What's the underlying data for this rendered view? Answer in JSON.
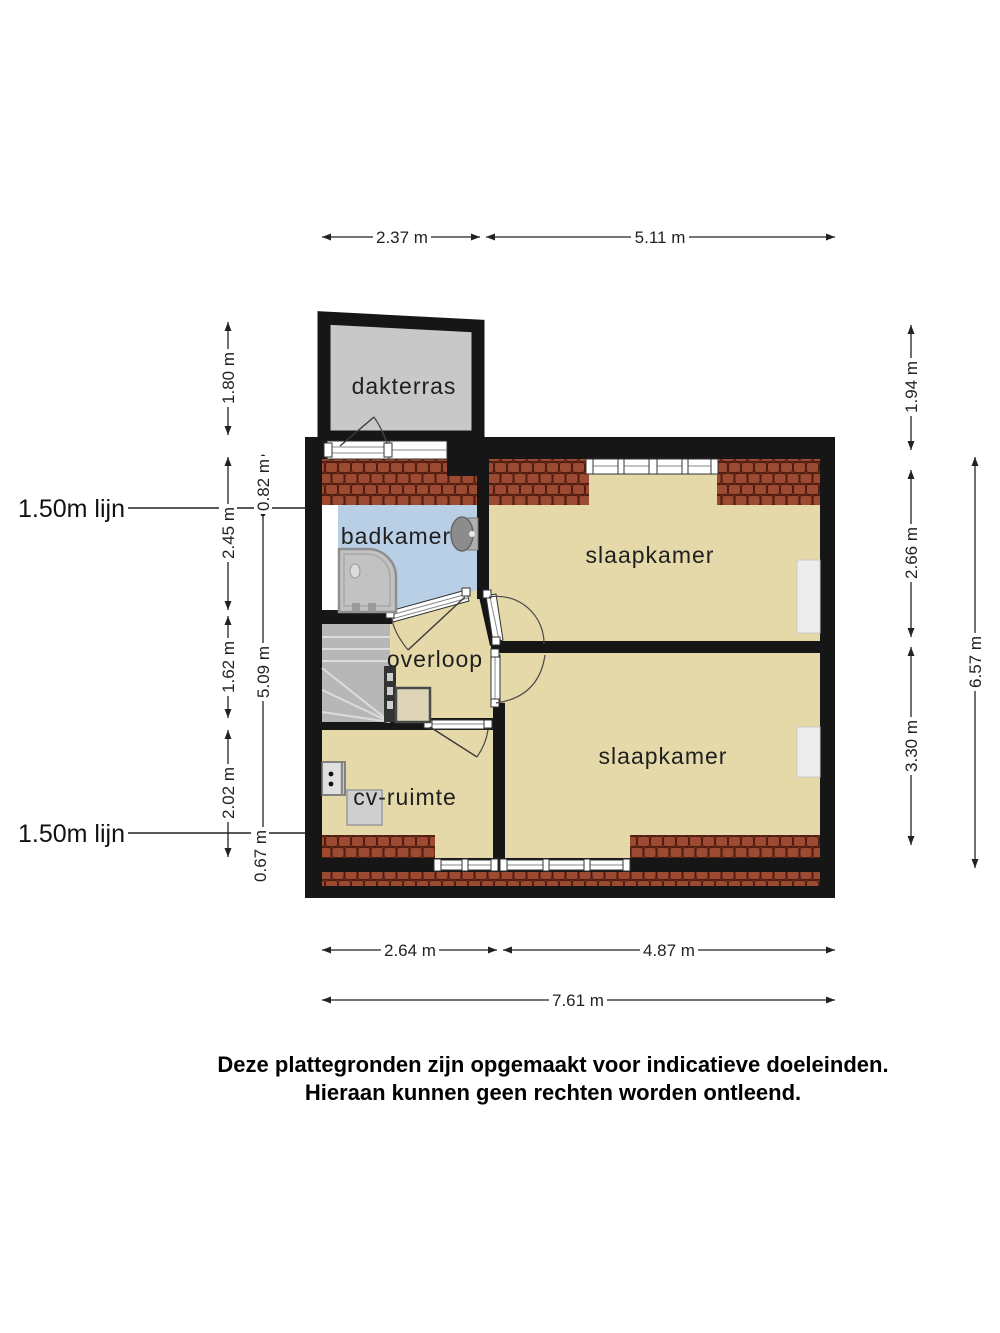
{
  "plan": {
    "rooms": {
      "dakterras": "dakterras",
      "badkamer": "badkamer",
      "slaapkamer_top": "slaapkamer",
      "overloop": "overloop",
      "slaapkamer_bottom": "slaapkamer",
      "cv_ruimte": "cv-ruimte"
    },
    "height_lines": {
      "top": "1.50m lijn",
      "bottom": "1.50m lijn"
    }
  },
  "dimensions": {
    "top_terrace_width": "2.37 m",
    "top_main_width": "5.11 m",
    "left_terrace_depth": "1.80 m",
    "left_badkamer": "2.45 m",
    "left_stairs": "1.62 m",
    "left_cv": "2.02 m",
    "inner_top_offset": "0.82 m",
    "inner_span": "5.09 m",
    "inner_bottom_offset": "0.67 m",
    "right_terrace": "1.94 m",
    "right_slaapkamer_top": "2.66 m",
    "right_slaapkamer_bottom": "3.30 m",
    "right_total": "6.57 m",
    "bottom_left_width": "2.64 m",
    "bottom_right_width": "4.87 m",
    "bottom_total": "7.61 m"
  },
  "disclaimer": {
    "line1": "Deze plattegronden zijn opgemaakt voor indicatieve doeleinden.",
    "line2": "Hieraan kunnen geen rechten worden ontleend."
  },
  "colors": {
    "wall": "#161616",
    "floor": "#e5d8a9",
    "bathroom_floor": "#b9cfe6",
    "terrace_floor": "#c8c8c8",
    "roof_tile": "#9c4a31",
    "roof_tile_dark": "#5a2213",
    "roof_band_bg": "#6e2c1c",
    "stairs": "#b7b7b7"
  }
}
